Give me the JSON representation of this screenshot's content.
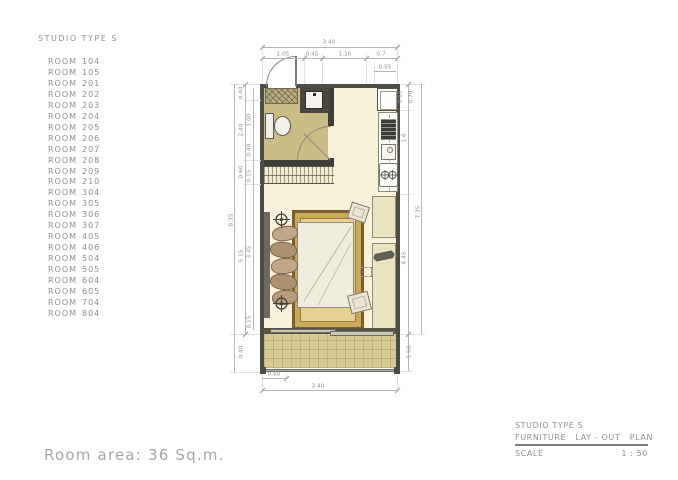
{
  "palette": {
    "floor_cream": "#f7f1d9",
    "bathroom_khaki": "#c9bc85",
    "balcony_tile": "#d6cb93",
    "rug_tan": "#e6d193",
    "rug_border": "#7b5f2c",
    "wall_dark": "#4f4c44",
    "pencil_gray": "#8e8e8e"
  },
  "room_list": {
    "title": "STUDIO TYPE S",
    "row_label": "ROOM",
    "items": [
      "104",
      "105",
      "201",
      "202",
      "203",
      "204",
      "205",
      "206",
      "207",
      "208",
      "209",
      "210",
      "304",
      "305",
      "306",
      "307",
      "405",
      "406",
      "504",
      "505",
      "604",
      "605",
      "704",
      "804"
    ]
  },
  "plan": {
    "dims": {
      "top_total": "3.40",
      "top_seg1": "1.05",
      "top_seg2": "0.45",
      "top_seg3": "1.10",
      "top_seg4": "0.7",
      "top_fridge": "0.55",
      "left_total": "8.35",
      "left_seg1": "0.40",
      "left_seg2": "2.40",
      "left_seg3": "0.60",
      "left_seg4": "5.15",
      "left_seg5": "0.40",
      "left_in1": "1.00",
      "left_in2": "0.40",
      "left_in3": "0.15",
      "left_in4": "3.45",
      "left_in5": "0.15",
      "right_seg1": "0.65",
      "right_seg2": "0.70",
      "right_seg3": "1.6",
      "right_seg4": "4.45",
      "right_total": "7.35",
      "right_balcony": "1.50",
      "bottom_seg1": "0.60",
      "bottom_total": "3.40"
    }
  },
  "footer": {
    "room_area": "Room area: 36 Sq.m."
  },
  "title_block": {
    "project": "STUDIO TYPE S",
    "drawing": "FURNITURE   LAY - OUT   PLAN",
    "scale_label": "SCALE",
    "scale_value": "1 : 50"
  }
}
